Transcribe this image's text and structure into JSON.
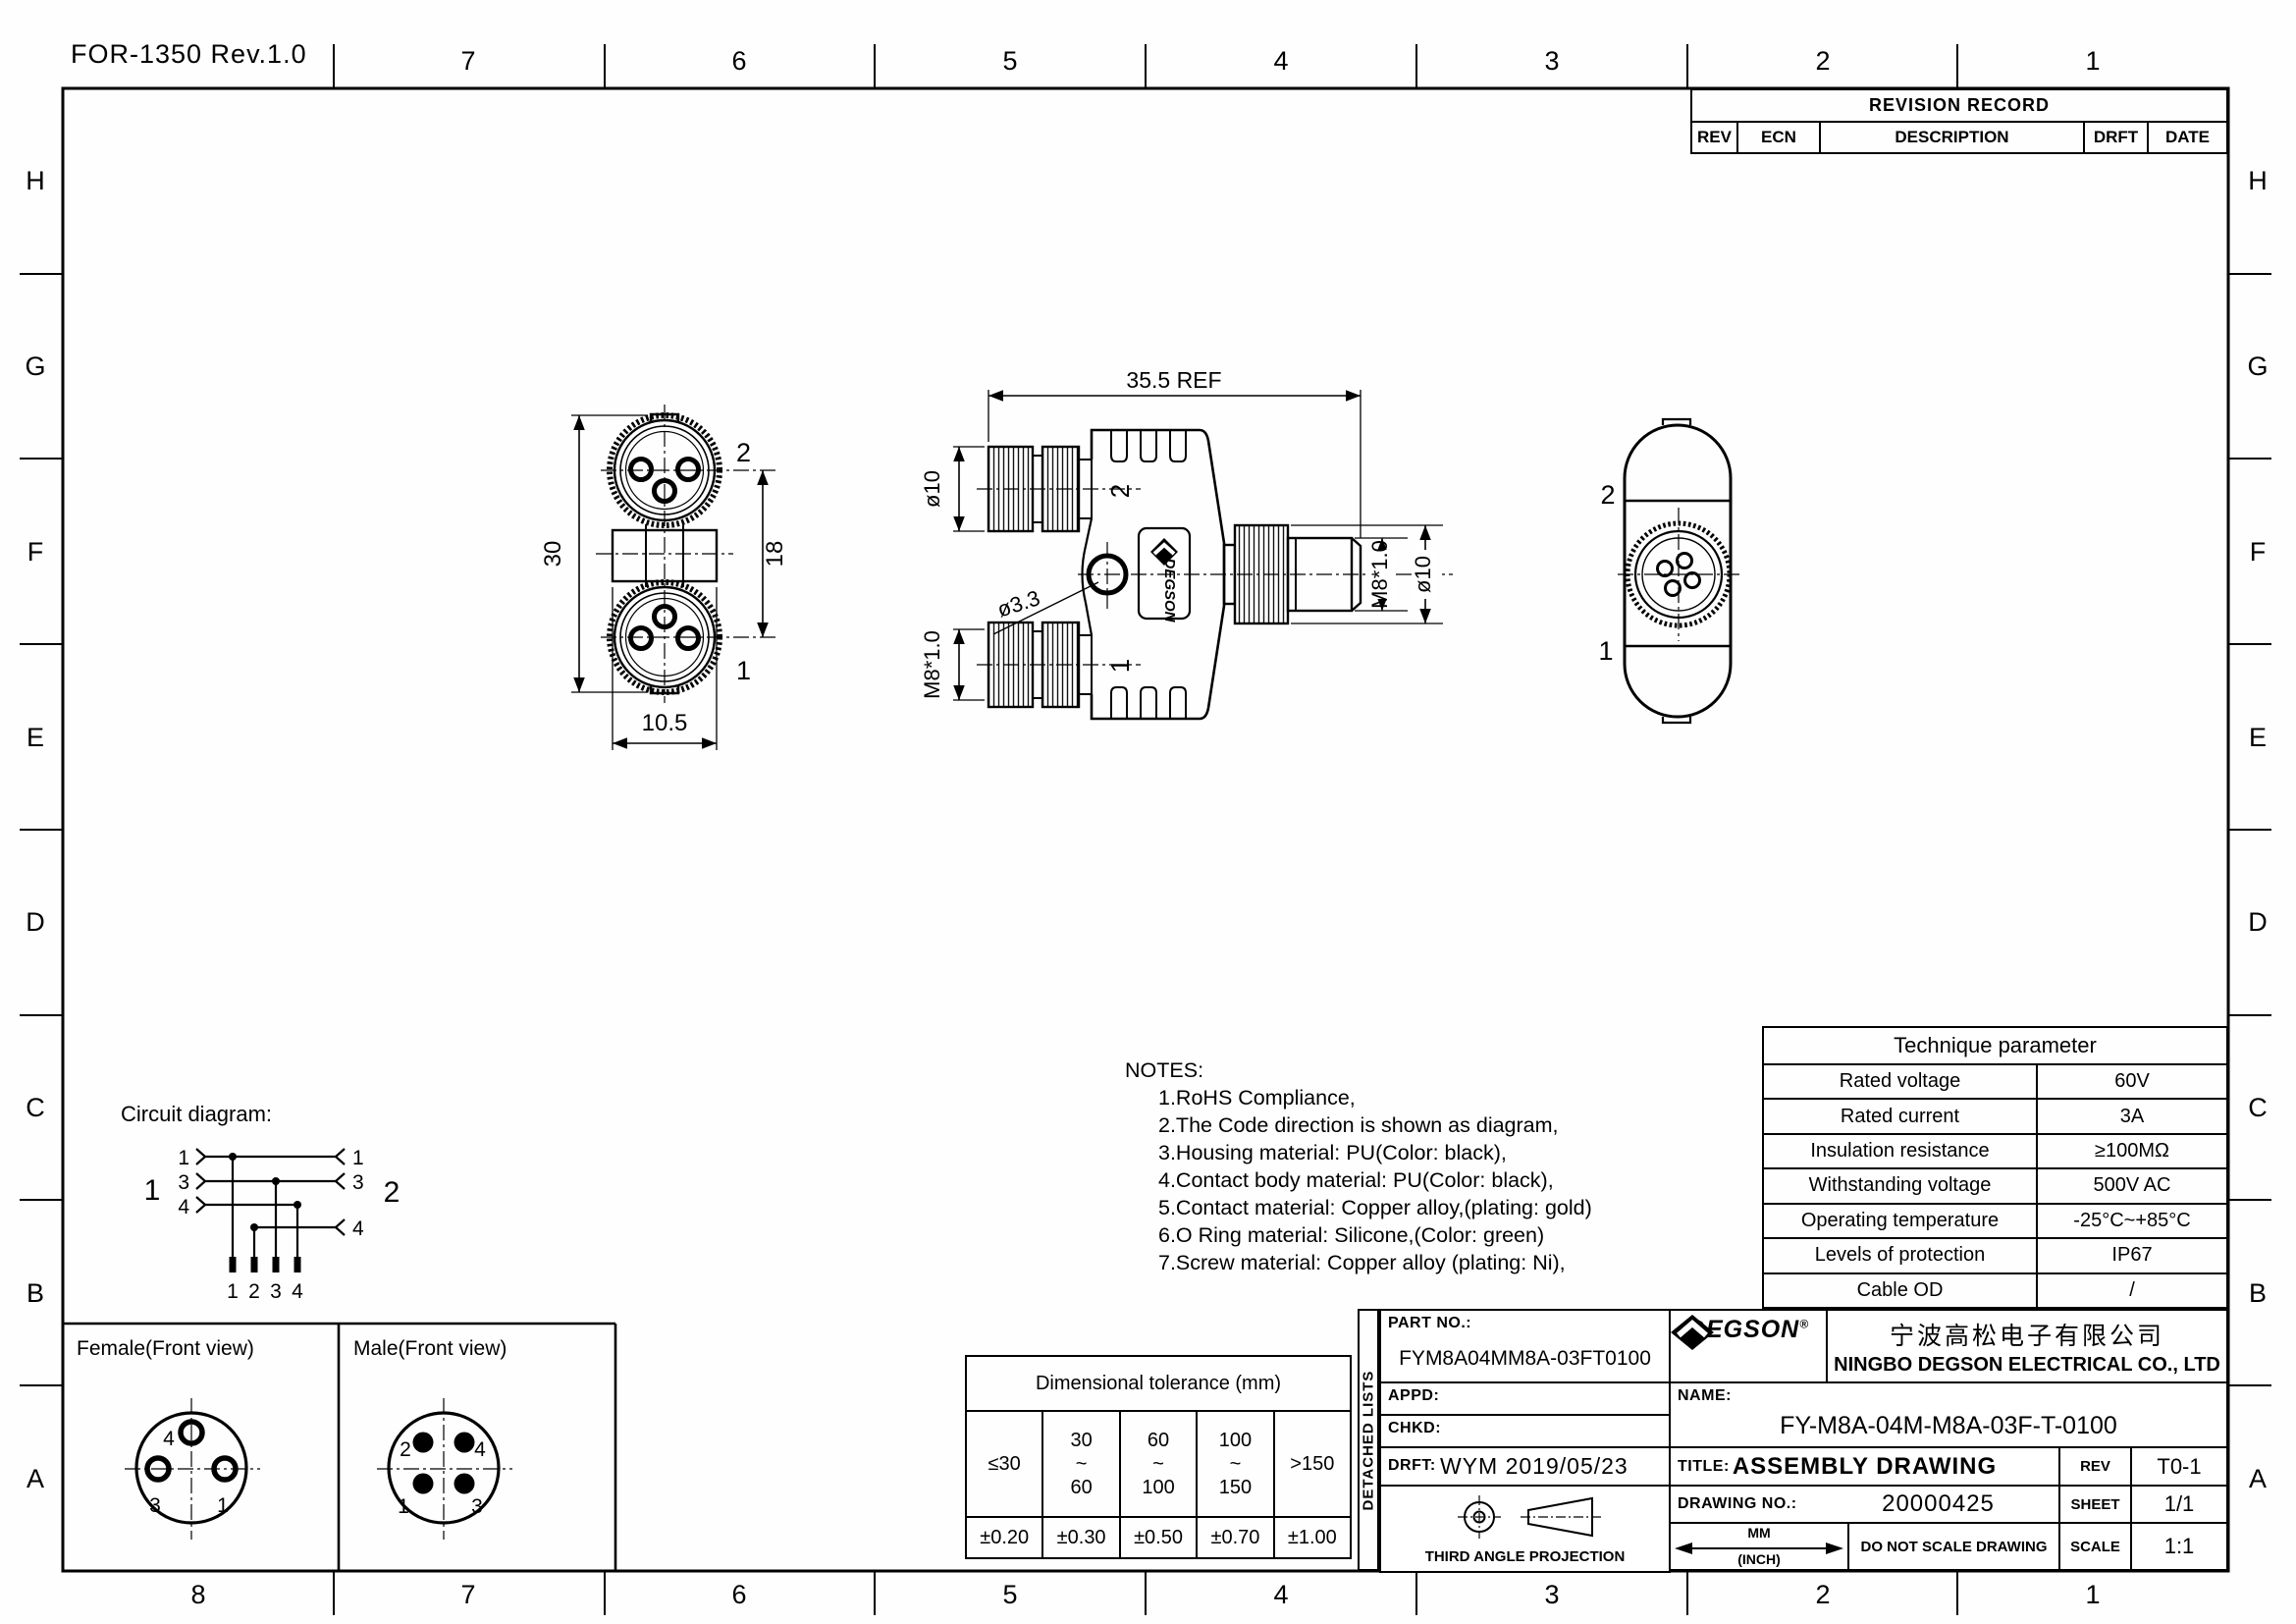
{
  "sheet": {
    "form_ref": "FOR-1350 Rev.1.0"
  },
  "grid": {
    "letters": [
      "H",
      "G",
      "F",
      "E",
      "D",
      "C",
      "B",
      "A"
    ],
    "top": [
      "7",
      "6",
      "5",
      "4",
      "3",
      "2",
      "1"
    ],
    "bottom": [
      "8",
      "7",
      "6",
      "5",
      "4",
      "3",
      "2",
      "1"
    ]
  },
  "revision": {
    "title": "REVISION RECORD",
    "cols": [
      "REV",
      "ECN",
      "DESCRIPTION",
      "DRFT",
      "DATE"
    ]
  },
  "views": {
    "front": {
      "dim_height": "30",
      "dim_pitch": "18",
      "dim_width": "10.5",
      "port_top": "2",
      "port_bottom": "1"
    },
    "side": {
      "dim_length": "35.5 REF",
      "dim_dia_left": "ø10",
      "dim_hole": "ø3.3",
      "dim_thread_left": "M8*1.0",
      "dim_thread_right": "M8*1.0",
      "dim_dia_right": "ø10",
      "port_top": "2",
      "port_bottom": "1",
      "logo": "DEGSON"
    },
    "back": {
      "port_top": "2",
      "port_bottom": "1"
    }
  },
  "circuit": {
    "title": "Circuit diagram:",
    "left_connector": "1",
    "right_connector": "2",
    "left_pins": [
      "1",
      "3",
      "4"
    ],
    "right_pins": [
      "1",
      "3",
      "4"
    ],
    "bottom_pins": [
      "1",
      "2",
      "3",
      "4"
    ]
  },
  "notes": {
    "title": "NOTES:",
    "items": [
      "1.RoHS Compliance,",
      "2.The Code direction is shown as diagram,",
      "3.Housing material: PU(Color: black),",
      "4.Contact body material: PU(Color: black),",
      "5.Contact material: Copper alloy,(plating: gold)",
      "6.O Ring material: Silicone,(Color: green)",
      "7.Screw material: Copper alloy (plating: Ni),"
    ]
  },
  "technique": {
    "title": "Technique parameter",
    "rows": [
      {
        "label": "Rated voltage",
        "value": "60V"
      },
      {
        "label": "Rated current",
        "value": "3A"
      },
      {
        "label": "Insulation resistance",
        "value": "≥100MΩ"
      },
      {
        "label": "Withstanding voltage",
        "value": "500V AC"
      },
      {
        "label": "Operating temperature",
        "value": "-25°C~+85°C"
      },
      {
        "label": "Levels of protection",
        "value": "IP67"
      },
      {
        "label": "Cable OD",
        "value": "/"
      }
    ]
  },
  "pin_views": {
    "female": {
      "title": "Female(Front view)",
      "pin_top": "4",
      "pin_left": "3",
      "pin_right": "1"
    },
    "male": {
      "title": "Male(Front view)",
      "pin_tl": "2",
      "pin_tr": "4",
      "pin_bl": "1",
      "pin_br": "3"
    }
  },
  "tolerance": {
    "title": "Dimensional tolerance (mm)",
    "ranges": [
      "≤30",
      "30\n~\n60",
      "60\n~\n100",
      "100\n~\n150",
      ">150"
    ],
    "values": [
      "±0.20",
      "±0.30",
      "±0.50",
      "±0.70",
      "±1.00"
    ]
  },
  "detached": "DETACHED LISTS",
  "title_block": {
    "part_no_label": "PART NO.:",
    "part_no": "FYM8A04MM8A-03FT0100",
    "appd_label": "APPD:",
    "chkd_label": "CHKD:",
    "drft_label": "DRFT:",
    "drft_value": "WYM  2019/05/23",
    "projection": "THIRD ANGLE PROJECTION",
    "logo_text": "DEGSON",
    "logo_reg": "®",
    "company_cn": "宁波高松电子有限公司",
    "company_en": "NINGBO DEGSON ELECTRICAL CO., LTD",
    "name_label": "NAME:",
    "name_value": "FY-M8A-04M-M8A-03F-T-0100",
    "title_label": "TITLE:",
    "title_value": "ASSEMBLY DRAWING",
    "rev_label": "REV",
    "rev_value": "T0-1",
    "drawing_no_label": "DRAWING NO.:",
    "drawing_no": "20000425",
    "sheet_label": "SHEET",
    "sheet_value": "1/1",
    "units_top": "MM",
    "units_bottom": "(INCH)",
    "do_not_scale": "DO NOT SCALE DRAWING",
    "scale_label": "SCALE",
    "scale_value": "1:1"
  }
}
